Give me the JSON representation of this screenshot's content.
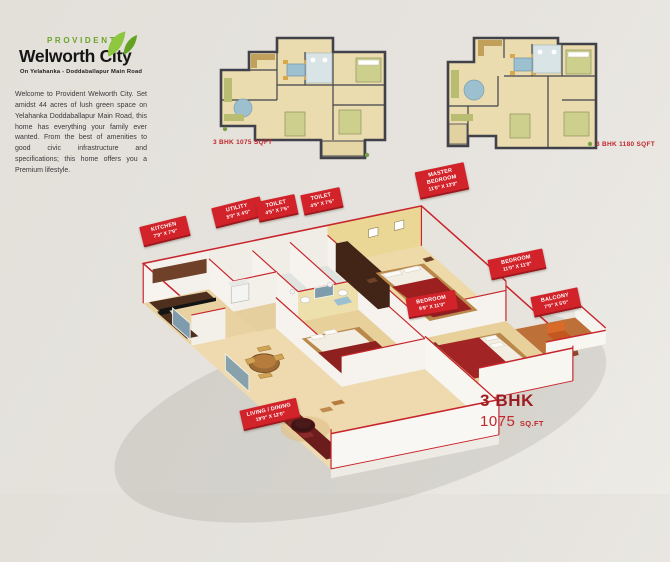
{
  "brand": {
    "logo_top": "PROVIDENT",
    "logo_main": "Welworth City",
    "tagline": "On Yelahanka - Doddaballapur Main Road",
    "welcome_text": "Welcome to Provident Welworth City. Set amidst 44 acres of lush green space on Yelahanka Doddaballapur Main Road, this home has everything your family ever wanted. From the best of amenities to good civic infrastructure and specifications; this home offers you a Premium lifestyle."
  },
  "floorplans_2d": [
    {
      "caption": "3 BHK 1075 SQFT"
    },
    {
      "caption": "3 BHK 1180 SQFT"
    }
  ],
  "room_labels": [
    {
      "name": "KITCHEN",
      "dims": "7'9\" X 7'9\""
    },
    {
      "name": "UTILITY",
      "dims": "5'0\" X 4'0\""
    },
    {
      "name": "TOILET",
      "dims": "4'5\" X 7'6\""
    },
    {
      "name": "TOILET",
      "dims": "4'5\" X 7'6\""
    },
    {
      "name": "MASTER BEDROOM",
      "dims": "11'0\" X 13'9\""
    },
    {
      "name": "BEDROOM",
      "dims": "11'0\" X 11'0\""
    },
    {
      "name": "BALCONY",
      "dims": "7'0\" X 5'0\""
    },
    {
      "name": "BEDROOM",
      "dims": "9'9\" X 11'0\""
    },
    {
      "name": "LIVING / DINING",
      "dims": "19'0\" X 12'0\""
    }
  ],
  "summary": {
    "bhk": "3 BHK",
    "area": "1075",
    "unit": "SQ.FT"
  },
  "colors": {
    "brand_green": "#76b82a",
    "label_red": "#d2232a",
    "caption_red": "#c1272d"
  }
}
